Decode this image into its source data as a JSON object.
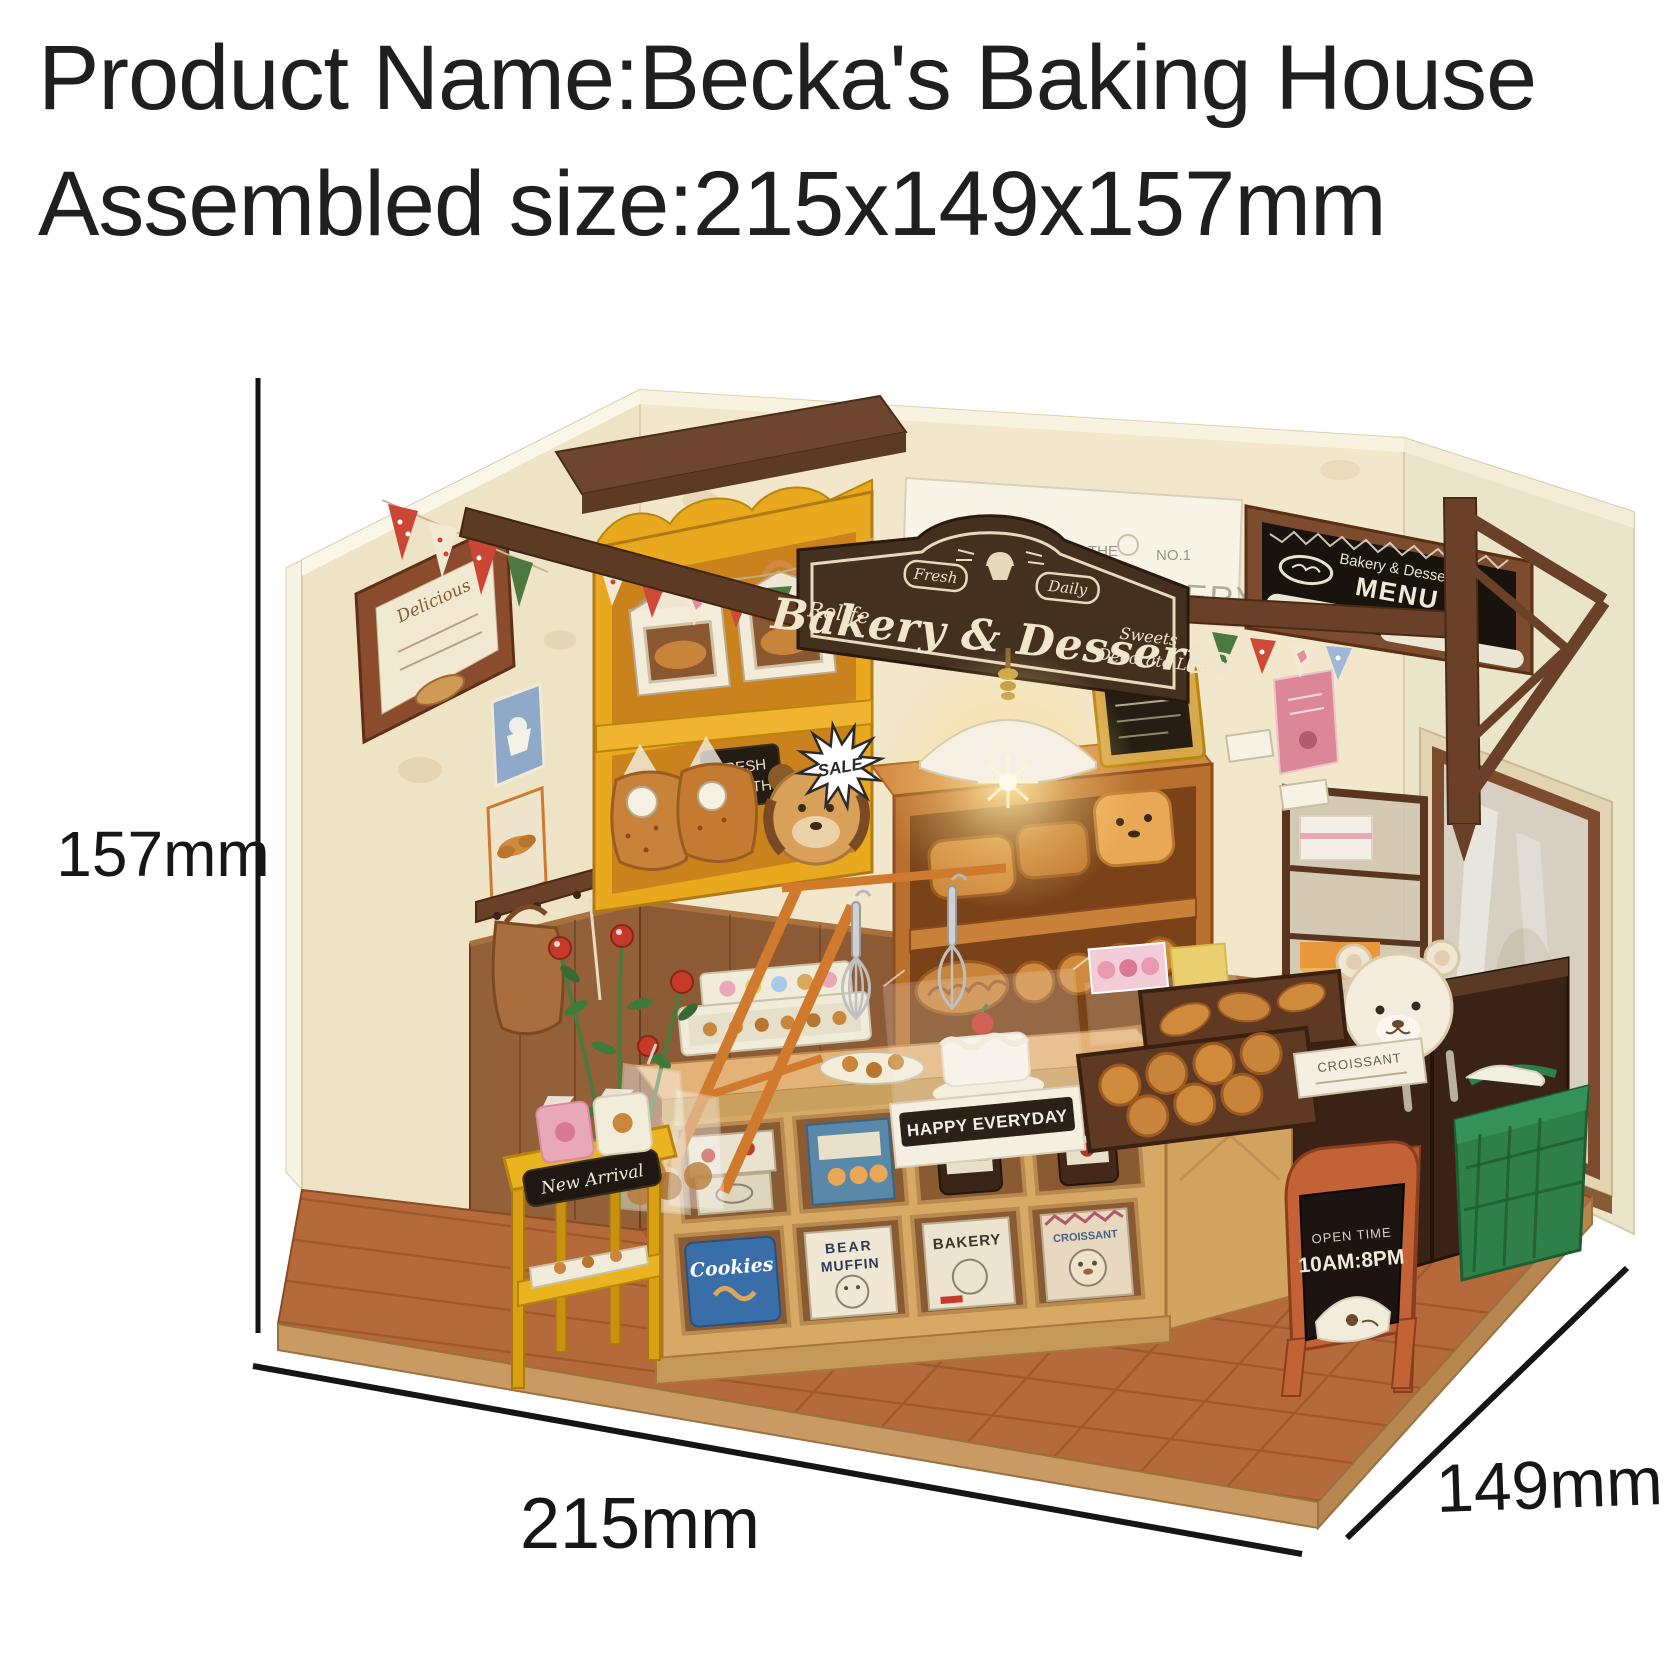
{
  "header": {
    "line1": "Product Name:Becka's Baking House",
    "line2": "Assembled size:215x149x157mm"
  },
  "dimensions": {
    "height": "157mm",
    "width": "215mm",
    "depth": "149mm"
  },
  "signage": {
    "hanging_sign": {
      "brand": "Rolife",
      "title": "Bakery & Desserts",
      "badge_left": "Fresh",
      "badge_right": "Daily",
      "tagline1": "Sweets",
      "tagline2": "Decorate Life"
    },
    "menu_board": {
      "header": "Bakery & Desserts",
      "title": "MENU",
      "item": "Desserts"
    },
    "wall_poster": {
      "word1": "THE",
      "word2": "NO.1",
      "word3": "BAKERY"
    },
    "framed_picture": "Delicious",
    "sale_burst": "SALE",
    "bread_bag_card1": "FRESH",
    "bread_bag_card2": "HEALTH",
    "cake_base": "HAPPY EVERYDAY",
    "croissant_label": "CROISSANT",
    "rack_sign": "New Arrival",
    "open_sign1": "OPEN TIME",
    "open_sign2": "10AM:8PM"
  },
  "counter_boxes": {
    "box1": "Cookies",
    "box2a": "BEAR",
    "box2b": "MUFFIN",
    "box3": "BAKERY",
    "box4": "CROISSANT"
  },
  "colors": {
    "page-bg": "#ffffff",
    "heading-ink": "#1f1f1f",
    "dimension-ink": "#161616",
    "wall-cream": "#efe3c6",
    "wood-dark": "#5d3a24",
    "cabinet-yellow": "#e9a91f",
    "floor-terracotta": "#b56a3b",
    "sign-brown": "#44301f",
    "basket-green": "#2e8048",
    "aframe-orange": "#c26236",
    "card-pink": "#db8798"
  }
}
